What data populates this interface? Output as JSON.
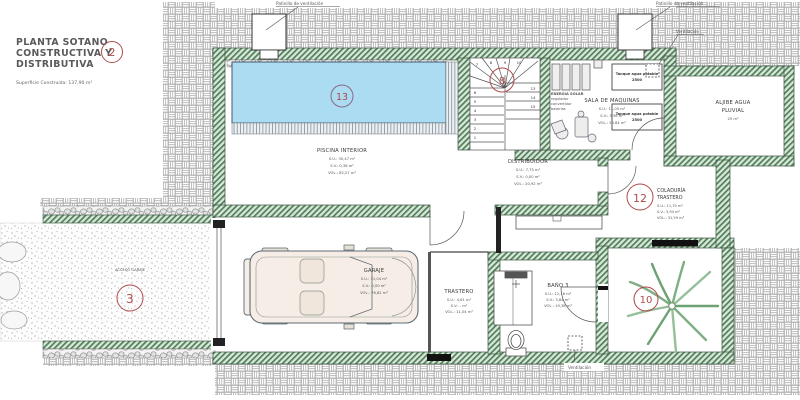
{
  "title": {
    "line1": "PLANTA SOTANO",
    "line2": "CONSTRUCTIVA Y",
    "line3": "DISTRIBUTIVA",
    "number": "2",
    "area_note": "Superficie Construida: 137,90 m²"
  },
  "annotations": {
    "patinillo_left": "Patinillo de ventilación",
    "patinillo_right": "Patinillo de ventilación",
    "ventilacion_top": "Ventilación",
    "ventilacion_bottom": "Ventilación"
  },
  "rooms": {
    "piscina": {
      "number": "13",
      "name": "PISCINA INTERIOR",
      "su": "S.U.: 30,47 m²",
      "sv": "S.V.: 0,36 m²",
      "vol": "VOL.: 82,27 m³"
    },
    "acceso_garaje": {
      "number": "3",
      "name": "ACCESO GARAJE"
    },
    "escalera": {
      "number": "8",
      "treads": [
        "1",
        "2",
        "3",
        "4",
        "5",
        "6",
        "7",
        "8",
        "9",
        "10",
        "13",
        "14",
        "15"
      ]
    },
    "sala_maquinas": {
      "name": "SALA DE MAQUINAS",
      "su": "S.U.: 11,05 m²",
      "sv": "S.V.: 3,36 m²",
      "vol": "VOL.: 29,84 m³",
      "energia_line1": "ENERGIA SOLAR",
      "energia_line2": "regulador",
      "energia_line3": "convertidor",
      "energia_line4": "baterías",
      "tanque": "Tanque agua potable",
      "tanque_capacidad": "2500"
    },
    "aljibe": {
      "name_line1": "ALJIBE AGUA",
      "name_line2": "PLUVIAL",
      "capacidad": "25 m³"
    },
    "distribuidor": {
      "name": "DISTRIBUIDOR",
      "su": "S.U.: 7,75 m²",
      "sv": "S.V.: 0,00 m²",
      "vol": "VOL.: 20,92 m³"
    },
    "coladuria": {
      "number": "12",
      "name_line1": "COLADURÍA",
      "name_line2": "TRASTERO",
      "su": "S.U.: 11,70 m²",
      "sv": "S.V.: 3,94 m²",
      "vol": "VOL.: 31,59 m³"
    },
    "garaje": {
      "name": "GARAJE",
      "su": "S.U.: 31,04 m²",
      "sv": "S.V.: 0,00 m²",
      "vol": "VOL.: 76,82 m³"
    },
    "trastero": {
      "name": "TRASTERO",
      "su": "S.U.: 4,61 m²",
      "sv": "S.V.: - m²",
      "vol": "VOL.: 11,04 m³"
    },
    "bano3": {
      "name": "BAÑO 3",
      "su": "S.U.: 12,16 m²",
      "sv": "S.V.: 3,84 m²",
      "vol": "VOL.: 19,38 m³"
    },
    "patio": {
      "number": "10"
    }
  },
  "colors": {
    "wall_green": "#4f7f58",
    "pool_blue": "#abdcf2",
    "marker_red": "#b04a4c"
  }
}
